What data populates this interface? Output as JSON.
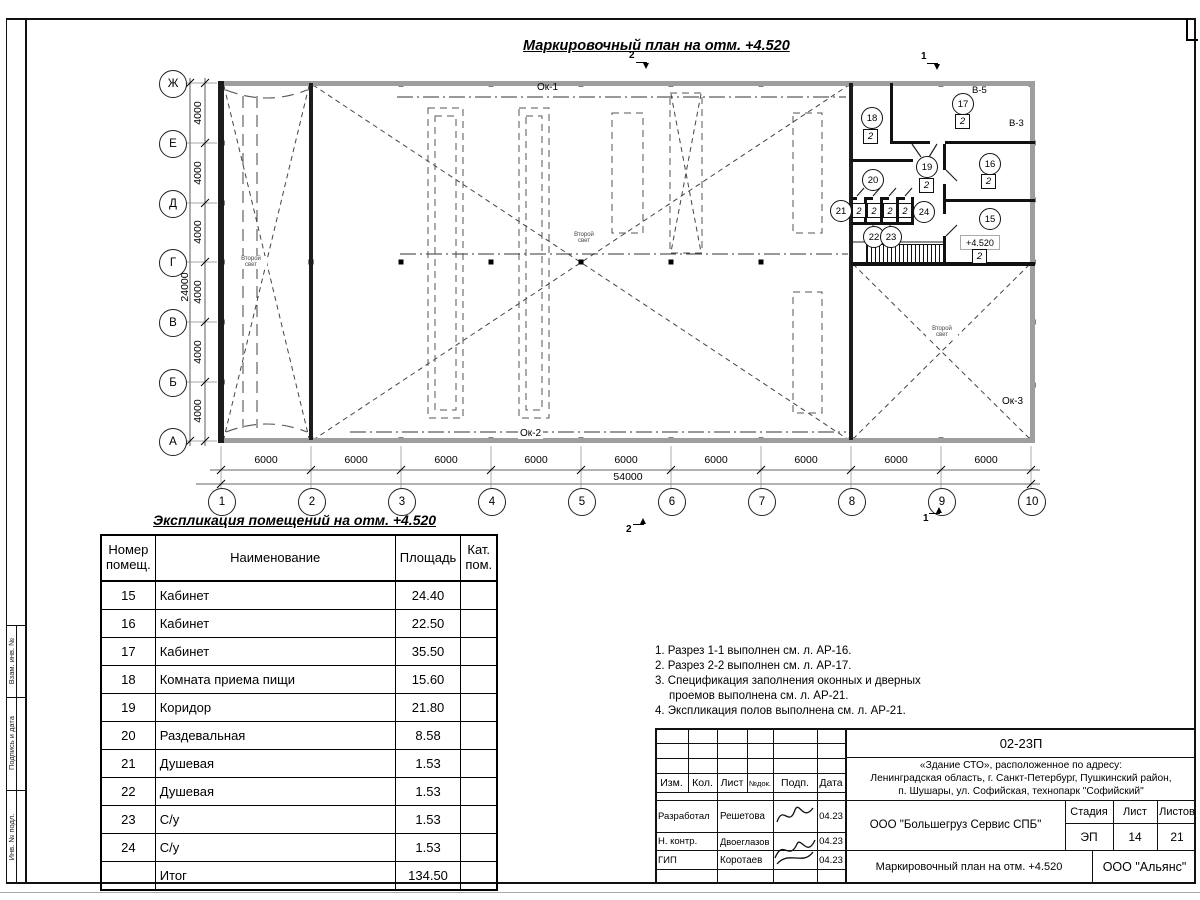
{
  "plan": {
    "title": "Маркировочный план на отм. +4.520",
    "axes_rows": [
      "Ж",
      "Е",
      "Д",
      "Г",
      "В",
      "Б",
      "А"
    ],
    "axes_cols": [
      "1",
      "2",
      "3",
      "4",
      "5",
      "6",
      "7",
      "8",
      "9",
      "10"
    ],
    "row_spacing_label": "4000",
    "row_total_label": "24000",
    "col_spacing_label": "6000",
    "col_total_label": "54000",
    "window_label_top": "Ок-1",
    "window_label_bottom": "Ок-2",
    "window_label_right": "Ок-3",
    "vent_label_1": "В-5",
    "vent_label_2": "В-3",
    "second_light_line1": "Второй",
    "second_light_line2": "свет",
    "level_mark": "+4.520",
    "category_label": "2",
    "section_mark_1": "1",
    "section_mark_2": "2",
    "room_tags": [
      "15",
      "16",
      "17",
      "18",
      "19",
      "20",
      "21",
      "22",
      "23",
      "24"
    ]
  },
  "table": {
    "title": "Экспликация помещений на отм. +4.520",
    "headers": {
      "num": "Номер помещ.",
      "name": "Наименование",
      "area": "Площадь",
      "cat": "Кат. пом."
    },
    "rows": [
      {
        "num": "15",
        "name": "Кабинет",
        "area": "24.40",
        "cat": ""
      },
      {
        "num": "16",
        "name": "Кабинет",
        "area": "22.50",
        "cat": ""
      },
      {
        "num": "17",
        "name": "Кабинет",
        "area": "35.50",
        "cat": ""
      },
      {
        "num": "18",
        "name": "Комната приема пищи",
        "area": "15.60",
        "cat": ""
      },
      {
        "num": "19",
        "name": "Коридор",
        "area": "21.80",
        "cat": ""
      },
      {
        "num": "20",
        "name": "Раздевальная",
        "area": "8.58",
        "cat": ""
      },
      {
        "num": "21",
        "name": "Душевая",
        "area": "1.53",
        "cat": ""
      },
      {
        "num": "22",
        "name": "Душевая",
        "area": "1.53",
        "cat": ""
      },
      {
        "num": "23",
        "name": "С/у",
        "area": "1.53",
        "cat": ""
      },
      {
        "num": "24",
        "name": "С/у",
        "area": "1.53",
        "cat": ""
      },
      {
        "num": "",
        "name": "Итог",
        "area": "134.50",
        "cat": ""
      }
    ]
  },
  "notes": {
    "n1": "1. Разрез 1-1 выполнен см. л. АР-16.",
    "n2": "2. Разрез 2-2 выполнен см. л. АР-17.",
    "n3": "3. Спецификация заполнения оконных и дверных проемов выполнена см. л. АР-21.",
    "n4": "4. Экспликация полов выполнена см. л. АР-21."
  },
  "titleblock": {
    "doc_code": "02-23П",
    "address_line1": "«Здание СТО», расположенное по адресу:",
    "address_line2": "Ленинградская область, г. Санкт-Петербург, Пушкинский район,",
    "address_line3": "п. Шушары, ул. Софийская, технопарк \"Софийский\"",
    "col_izm": "Изм.",
    "col_kol": "Кол.",
    "col_list": "Лист",
    "col_ndok": "№док.",
    "col_podp": "Подп.",
    "col_data": "Дата",
    "row1_role": "Разработал",
    "row1_name": "Решетова",
    "row1_date": "04.23",
    "row2_role": "Н. контр.",
    "row2_name": "Двоеглазов",
    "row2_date": "04.23",
    "row3_role": "ГИП",
    "row3_name": "Коротаев",
    "row3_date": "04.23",
    "company": "ООО \"Большегруз Сервис СПБ\"",
    "stage_label": "Стадия",
    "sheet_label": "Лист",
    "sheets_label": "Листов",
    "stage": "ЭП",
    "sheet": "14",
    "sheets": "21",
    "drawing_name": "Маркировочный план на отм. +4.520",
    "firm": "ООО \"Альянс\""
  },
  "margin": {
    "f1": "Взам. инв. №",
    "f2": "Подпись и дата",
    "f3": "Инв. № подл."
  }
}
